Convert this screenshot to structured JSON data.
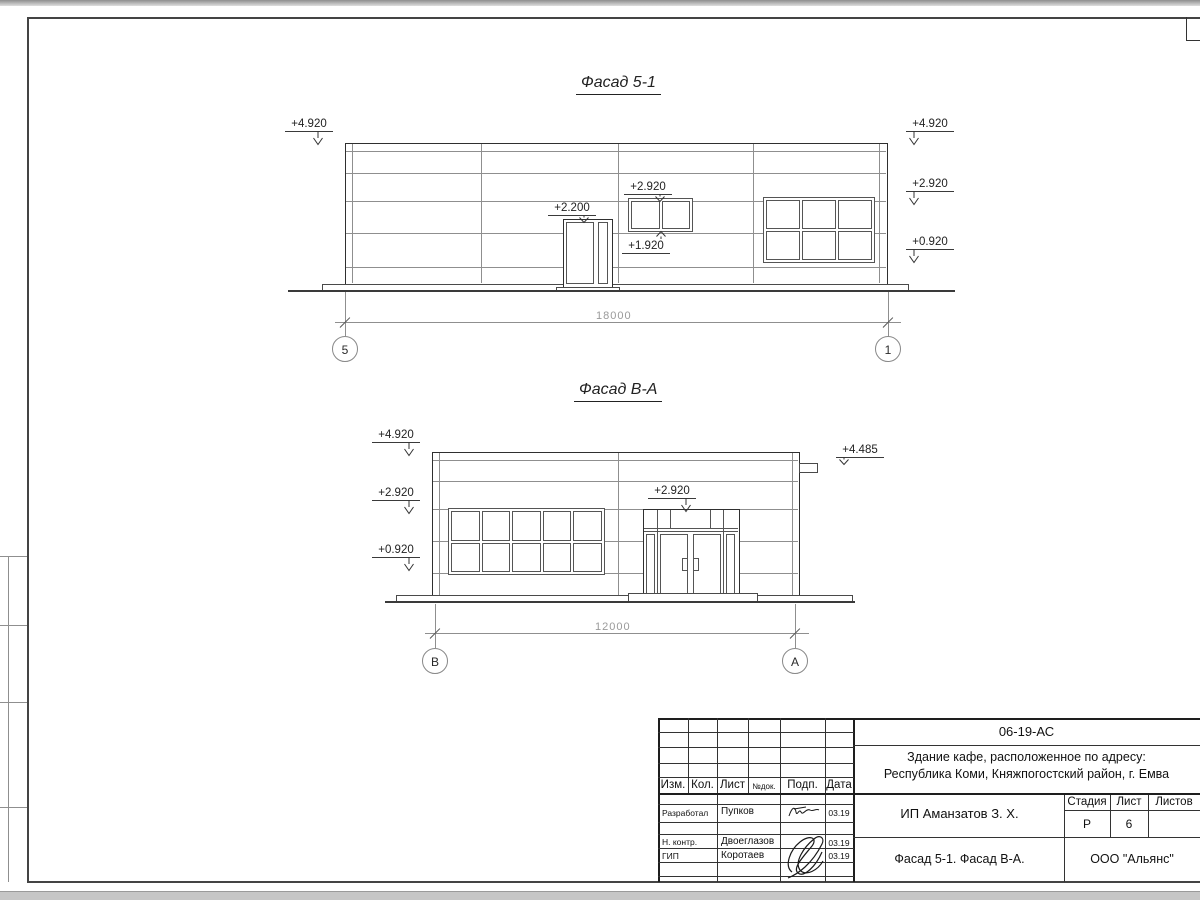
{
  "facade1": {
    "title": "Фасад 5-1",
    "mark_left_top": "+4.920",
    "mark_right_top": "+4.920",
    "mark_right_mid": "+2.920",
    "mark_right_low": "+0.920",
    "mark_window_top": "+2.920",
    "mark_window_sill": "+1.920",
    "mark_door": "+2.200",
    "dim_total": "18000",
    "axis_start": "5",
    "axis_end": "1"
  },
  "facade2": {
    "title": "Фасад В-А",
    "mark_left_top": "+4.920",
    "mark_left_mid": "+2.920",
    "mark_left_low": "+0.920",
    "mark_entrance": "+2.920",
    "mark_right": "+4.485",
    "dim_total": "12000",
    "axis_start": "В",
    "axis_end": "А"
  },
  "stamp": {
    "doc_number": "06-19-АС",
    "project_line1": "Здание кафе, расположенное по адресу:",
    "project_line2": "Республика Коми, Княжпогостский район, г. Емва",
    "client": "ИП Аманзатов З. Х.",
    "sheet_name": "Фасад 5-1. Фасад В-А.",
    "company": "ООО \"Альянс\"",
    "col_izm": "Изм.",
    "col_kol": "Кол.",
    "col_list": "Лист",
    "col_ndok": "№док.",
    "col_podp": "Подп.",
    "col_data": "Дата",
    "stage_label": "Стадия",
    "list_label": "Лист",
    "listov_label": "Листов",
    "stage_value": "Р",
    "list_value": "6",
    "row1_role": "Разработал",
    "row1_name": "Пупков",
    "row1_date": "03.19",
    "row2_role": "Н. контр.",
    "row2_name": "Двоеглазов",
    "row2_date": "03.19",
    "row3_role": "ГИП",
    "row3_name": "Коротаев",
    "row3_date": "03.19"
  },
  "margin": {
    "label_upper": "Взам. инв. №",
    "label_middle": "Подп. и дата",
    "label_lower": "Инв. № подл."
  }
}
